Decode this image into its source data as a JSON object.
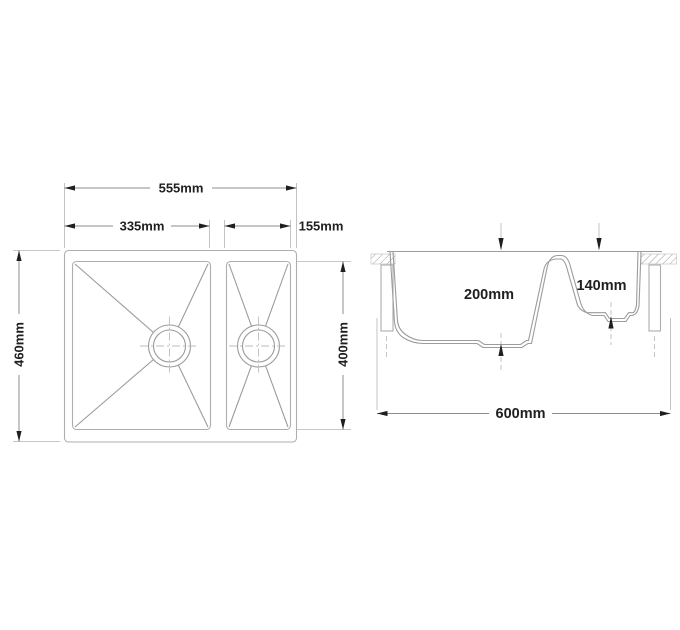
{
  "drawing": {
    "type": "sink-technical-drawing",
    "plan": {
      "width_total": "555mm",
      "width_bowl_main": "335mm",
      "width_bowl_small": "155mm",
      "depth_total": "460mm",
      "length_bowls": "400mm"
    },
    "section": {
      "depth_bowl_main": "200mm",
      "depth_bowl_small": "140mm",
      "width_cabinet": "600mm"
    },
    "colors": {
      "paper": "#ffffff",
      "geometry": "#aeaeae",
      "geometry-dark": "#9c9c9c",
      "dimline": "#8c8c8c",
      "extline": "#b4b4b4",
      "centerline": "#bdbdbd",
      "ink": "#1f1f1f"
    }
  }
}
